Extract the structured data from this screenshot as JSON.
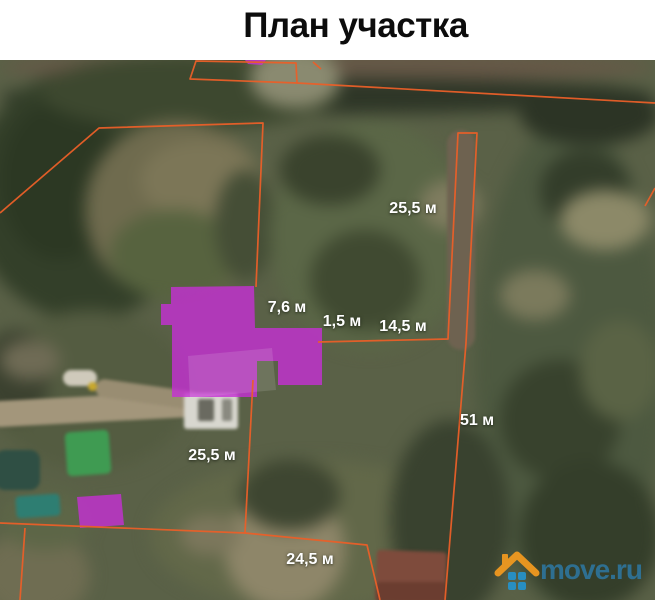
{
  "title": "План участка",
  "map": {
    "boundary_color": "#ea5f28",
    "building_color": "#c52fd4",
    "building_opacity": 0.8,
    "labels": [
      {
        "id": "dim-top-25-5",
        "text": "25,5 м",
        "x": 413,
        "y": 149
      },
      {
        "id": "dim-7-6",
        "text": "7,6 м",
        "x": 287,
        "y": 248
      },
      {
        "id": "dim-1-5",
        "text": "1,5 м",
        "x": 342,
        "y": 262
      },
      {
        "id": "dim-14-5",
        "text": "14,5 м",
        "x": 403,
        "y": 267
      },
      {
        "id": "dim-51",
        "text": "51 м",
        "x": 477,
        "y": 361
      },
      {
        "id": "dim-left-25-5",
        "text": "25,5 м",
        "x": 212,
        "y": 396
      },
      {
        "id": "dim-24-5",
        "text": "24,5 м",
        "x": 310,
        "y": 500
      }
    ],
    "boundaries": [
      {
        "id": "north-plot-outline",
        "closed": true,
        "points": [
          [
            196,
            1
          ],
          [
            190,
            19
          ],
          [
            297,
            23
          ],
          [
            296,
            3
          ]
        ]
      },
      {
        "id": "north-road-line",
        "closed": false,
        "points": [
          [
            297,
            23
          ],
          [
            655,
            43
          ]
        ]
      },
      {
        "id": "north-neighbor-edge",
        "closed": false,
        "points": [
          [
            313,
            2
          ],
          [
            321,
            9
          ]
        ]
      },
      {
        "id": "east-neighbor-edge",
        "closed": false,
        "points": [
          [
            655,
            128
          ],
          [
            645,
            146
          ]
        ]
      },
      {
        "id": "upper-plot-outline",
        "closed": false,
        "points": [
          [
            0,
            153
          ],
          [
            99,
            68
          ],
          [
            263,
            63
          ],
          [
            256,
            227
          ]
        ]
      },
      {
        "id": "east-plot-outline",
        "closed": false,
        "points": [
          [
            318,
            282
          ],
          [
            448,
            279
          ],
          [
            458,
            73
          ],
          [
            477,
            73
          ],
          [
            466,
            283
          ],
          [
            445,
            540
          ]
        ]
      },
      {
        "id": "mid-divider-line",
        "closed": false,
        "points": [
          [
            253,
            320
          ],
          [
            245,
            473
          ]
        ]
      },
      {
        "id": "south-plot-outline",
        "closed": false,
        "points": [
          [
            0,
            463
          ],
          [
            245,
            473
          ],
          [
            367,
            485
          ],
          [
            380,
            540
          ]
        ]
      },
      {
        "id": "southwest-divider",
        "closed": false,
        "points": [
          [
            25,
            468
          ],
          [
            20,
            540
          ]
        ]
      }
    ],
    "buildings": [
      {
        "id": "main-house",
        "points": [
          [
            171,
            227
          ],
          [
            254,
            226
          ],
          [
            255,
            268
          ],
          [
            322,
            268
          ],
          [
            322,
            325
          ],
          [
            278,
            325
          ],
          [
            278,
            301
          ],
          [
            257,
            301
          ],
          [
            257,
            337
          ],
          [
            172,
            337
          ],
          [
            172,
            265
          ],
          [
            161,
            265
          ],
          [
            161,
            244
          ],
          [
            171,
            244
          ]
        ]
      },
      {
        "id": "outbuilding",
        "points": [
          [
            77,
            437
          ],
          [
            121,
            434
          ],
          [
            124,
            465
          ],
          [
            80,
            468
          ]
        ]
      },
      {
        "id": "north-building-sliver",
        "points": [
          [
            245,
            0
          ],
          [
            266,
            0
          ],
          [
            262,
            5
          ],
          [
            248,
            4
          ]
        ]
      }
    ]
  },
  "watermark": {
    "text": "move.ru",
    "text_color": "#2d7aa8",
    "roof_color": "#f59b1f",
    "squares_color": "#2593cc"
  }
}
